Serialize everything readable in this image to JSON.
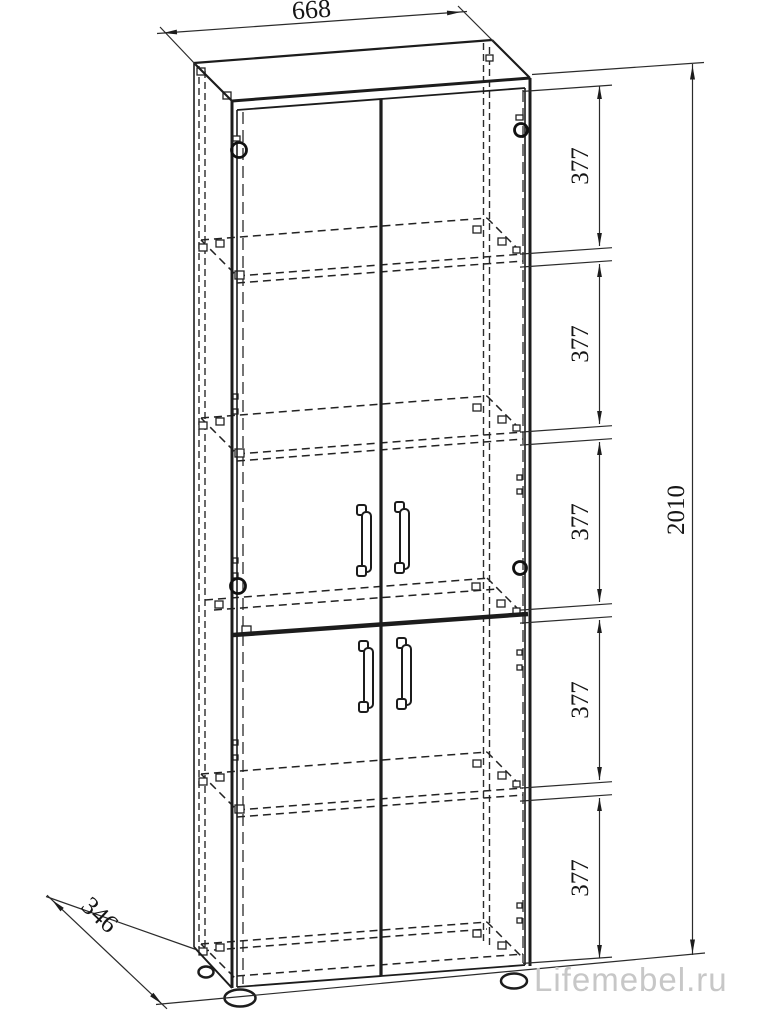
{
  "drawing": {
    "type": "furniture-assembly-diagram",
    "subject": "two-door tall cabinet with shelves, axonometric view",
    "dimensions": {
      "width": "668",
      "depth": "346",
      "height": "2010",
      "sections": [
        "377",
        "377",
        "377",
        "377",
        "377"
      ]
    },
    "watermark": {
      "text": "Lifemebel.ru",
      "color": "#c7c7c7"
    },
    "colors": {
      "line": "#1c1c1c",
      "dimension": "#2b2b2b",
      "background": "#ffffff"
    }
  }
}
